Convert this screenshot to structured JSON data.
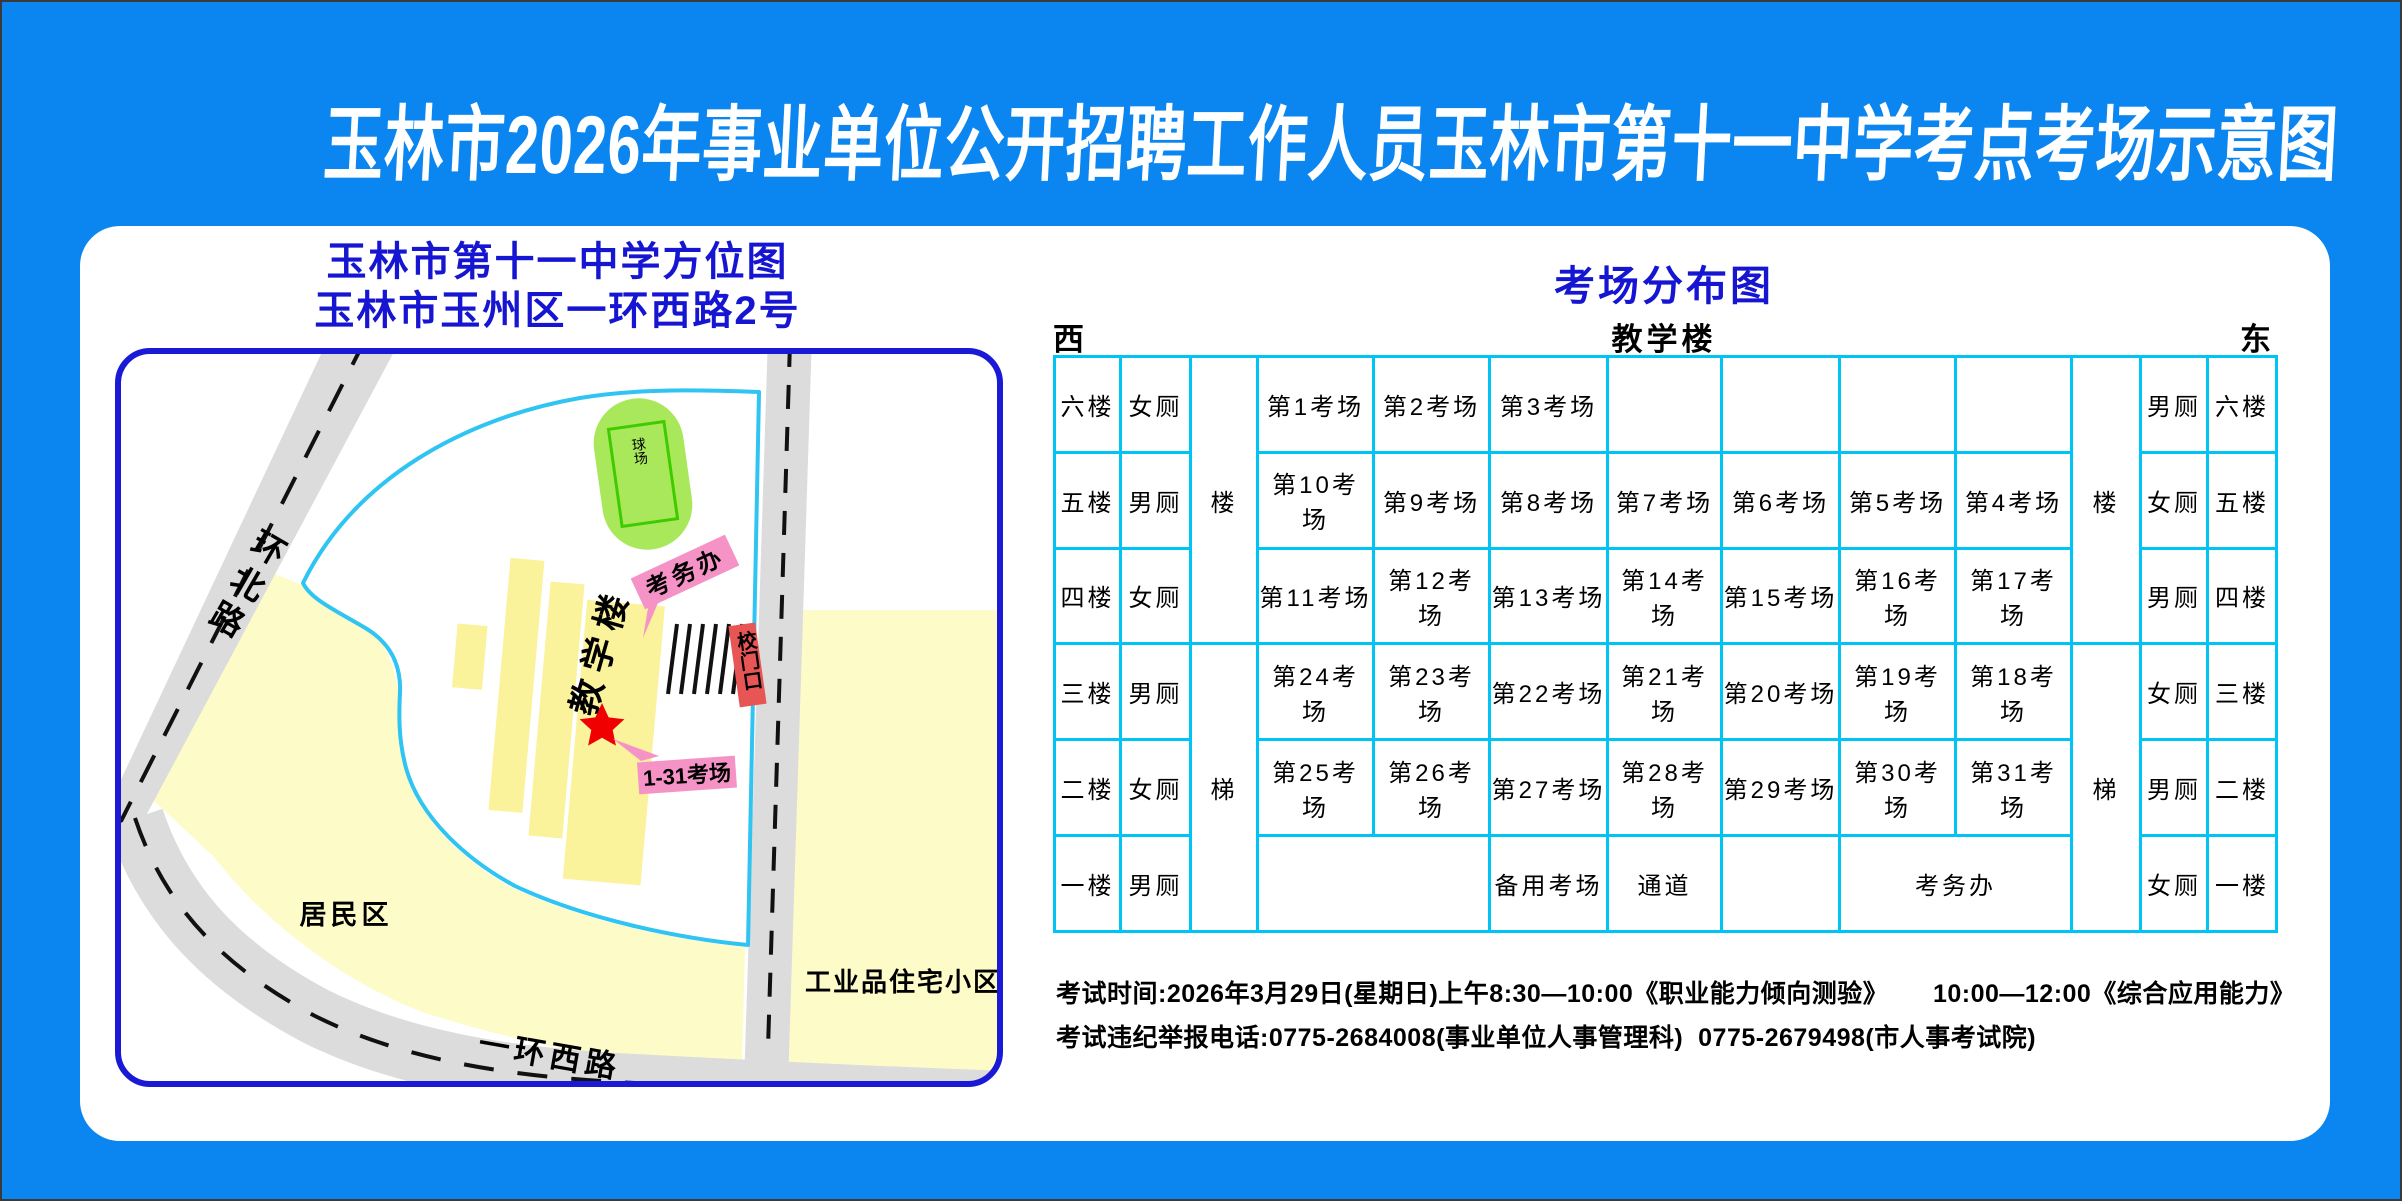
{
  "title": "玉林市2026年事业单位公开招聘工作人员玉林市第十一中学考点考场示意图",
  "colors": {
    "background": "#0b86f0",
    "title_text": "#ffffff",
    "heading_blue": "#1515d2",
    "table_border": "#00c4f4",
    "map_border": "#1a1ad6",
    "road_gray": "#dcdcdc",
    "district_yellow": "#fdfcc8",
    "building_yellow": "#fbf29c",
    "campus_line_cyan": "#2fc4f2",
    "court_green": "#a9e85a",
    "banner_pink": "#f693c6",
    "gate_red": "#e85555",
    "star_red": "#f00000"
  },
  "left_panel": {
    "heading_line1": "玉林市第十一中学方位图",
    "heading_line2": "玉林市玉州区一环西路2号",
    "map": {
      "road_north": "环北路",
      "road_west": "一环西路",
      "residential": "居民区",
      "industrial": "工业品住宅小区",
      "building": "教学楼",
      "court": "球场",
      "exam_office": "考务办",
      "gate": "校门口",
      "rooms_label": "1-31考场"
    }
  },
  "right_panel": {
    "heading": "考场分布图",
    "dir_west": "西",
    "dir_center": "教学楼",
    "dir_east": "东",
    "table": {
      "col_widths": [
        66,
        70,
        67,
        116,
        116,
        118,
        114,
        118,
        116,
        116,
        69,
        67,
        69
      ],
      "row_height": 95.8,
      "rows": [
        [
          {
            "t": "六楼"
          },
          {
            "t": "女厕"
          },
          {
            "t": "楼",
            "rs": 3
          },
          {
            "t": "第1考场"
          },
          {
            "t": "第2考场"
          },
          {
            "t": "第3考场"
          },
          {
            "t": ""
          },
          {
            "t": ""
          },
          {
            "t": ""
          },
          {
            "t": ""
          },
          {
            "t": "楼",
            "rs": 3
          },
          {
            "t": "男厕"
          },
          {
            "t": "六楼"
          }
        ],
        [
          {
            "t": "五楼"
          },
          {
            "t": "男厕"
          },
          {
            "t": "第10考场"
          },
          {
            "t": "第9考场"
          },
          {
            "t": "第8考场"
          },
          {
            "t": "第7考场"
          },
          {
            "t": "第6考场"
          },
          {
            "t": "第5考场"
          },
          {
            "t": "第4考场"
          },
          {
            "t": "女厕"
          },
          {
            "t": "五楼"
          }
        ],
        [
          {
            "t": "四楼"
          },
          {
            "t": "女厕"
          },
          {
            "t": "第11考场"
          },
          {
            "t": "第12考场"
          },
          {
            "t": "第13考场"
          },
          {
            "t": "第14考场"
          },
          {
            "t": "第15考场"
          },
          {
            "t": "第16考场"
          },
          {
            "t": "第17考场"
          },
          {
            "t": "男厕"
          },
          {
            "t": "四楼"
          }
        ],
        [
          {
            "t": "三楼"
          },
          {
            "t": "男厕"
          },
          {
            "t": "梯",
            "rs": 3
          },
          {
            "t": "第24考场"
          },
          {
            "t": "第23考场"
          },
          {
            "t": "第22考场"
          },
          {
            "t": "第21考场"
          },
          {
            "t": "第20考场"
          },
          {
            "t": "第19考场"
          },
          {
            "t": "第18考场"
          },
          {
            "t": "梯",
            "rs": 3
          },
          {
            "t": "女厕"
          },
          {
            "t": "三楼"
          }
        ],
        [
          {
            "t": "二楼"
          },
          {
            "t": "女厕"
          },
          {
            "t": "第25考场"
          },
          {
            "t": "第26考场"
          },
          {
            "t": "第27考场"
          },
          {
            "t": "第28考场"
          },
          {
            "t": "第29考场"
          },
          {
            "t": "第30考场"
          },
          {
            "t": "第31考场"
          },
          {
            "t": "男厕"
          },
          {
            "t": "二楼"
          }
        ],
        [
          {
            "t": "一楼"
          },
          {
            "t": "男厕"
          },
          {
            "t": "",
            "cs": 2
          },
          {
            "t": "备用考场"
          },
          {
            "t": "通道"
          },
          {
            "t": ""
          },
          {
            "t": "考务办",
            "cs": 2
          },
          {
            "t": "女厕"
          },
          {
            "t": "一楼"
          }
        ]
      ]
    },
    "notes": [
      "考试时间:2026年3月29日(星期日)上午8:30—10:00《职业能力倾向测验》      10:00—12:00《综合应用能力》",
      "考试违纪举报电话:0775-2684008(事业单位人事管理科)  0775-2679498(市人事考试院)"
    ]
  }
}
